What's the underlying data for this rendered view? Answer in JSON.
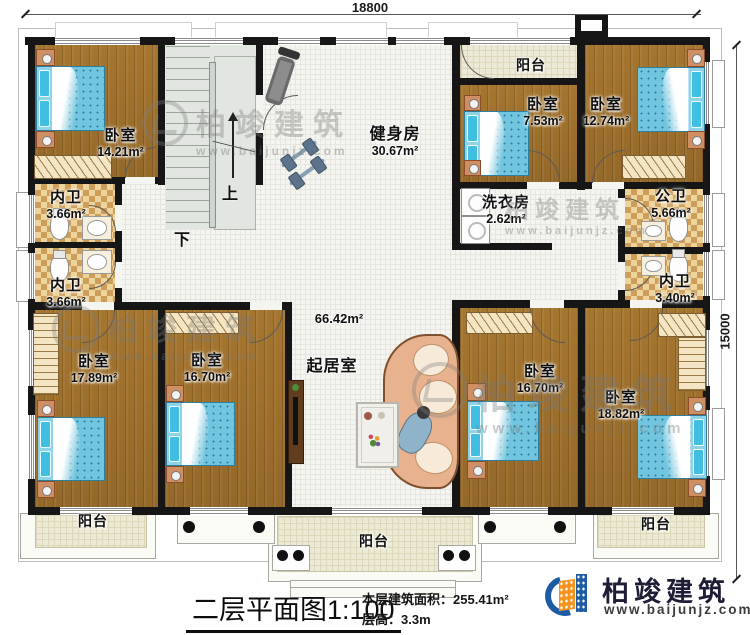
{
  "plan": {
    "title": "二层平面图",
    "scale": "1:100",
    "stats": {
      "area_label": "本层建筑面积：",
      "area_value": "255.41m²",
      "height_label": "层高：",
      "height_value": "3.3m"
    },
    "dimensions": {
      "width": "18800",
      "height": "15000"
    }
  },
  "rooms": {
    "bedroom_tl": {
      "label": "卧室",
      "area": "14.21m²"
    },
    "neiwei_upper": {
      "label": "内卫",
      "area": "3.66m²"
    },
    "neiwei_lower": {
      "label": "内卫",
      "area": "3.66m²"
    },
    "gym": {
      "label": "健身房",
      "area": "30.67m²"
    },
    "balcony_top": {
      "label": "阳台"
    },
    "bedroom_753": {
      "label": "卧室",
      "area": "7.53m²"
    },
    "bedroom_1274": {
      "label": "卧室",
      "area": "12.74m²"
    },
    "laundry": {
      "label": "洗衣房",
      "area": "2.62m²"
    },
    "gongwei": {
      "label": "公卫",
      "area": "5.66m²"
    },
    "neiwei_340": {
      "label": "内卫",
      "area": "3.40m²"
    },
    "bedroom_1789": {
      "label": "卧室",
      "area": "17.89m²"
    },
    "bedroom_1670l": {
      "label": "卧室",
      "area": "16.70m²"
    },
    "living": {
      "label": "起居室",
      "area": "66.42m²"
    },
    "bedroom_1670r": {
      "label": "卧室",
      "area": "16.70m²"
    },
    "bedroom_1882": {
      "label": "卧室",
      "area": "18.82m²"
    },
    "balcony_bl": {
      "label": "阳台"
    },
    "balcony_bc": {
      "label": "阳台"
    },
    "balcony_br": {
      "label": "阳台"
    }
  },
  "stairs": {
    "up": "上",
    "down": "下"
  },
  "brand": {
    "name": "柏竣建筑",
    "url": "www.baijunjz.com"
  },
  "watermark": {
    "name": "柏竣建筑",
    "url": "www.baijunjz.com"
  },
  "colors": {
    "wall": "#161616",
    "wood": "#9d6f2c",
    "bed_blue": "#72c5de",
    "checker_tan": "#ecd49c",
    "logo_blue": "#1d5ca5",
    "logo_orange": "#f7941d"
  }
}
